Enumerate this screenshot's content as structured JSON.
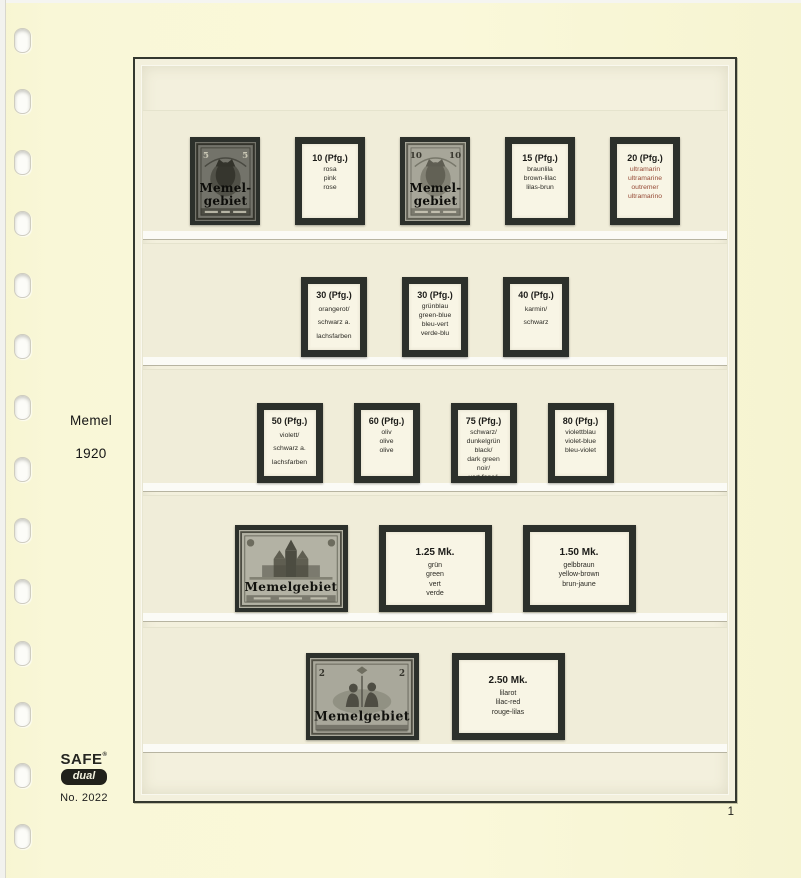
{
  "sidebar": {
    "title": "Memel",
    "year": "1920"
  },
  "footer": {
    "brand_top": "SAFE",
    "brand_reg": "®",
    "brand_bottom": "dual",
    "item_number": "No. 2022",
    "page_number": "1"
  },
  "palette": {
    "page_background": "#f9f7d8",
    "mount_black": "#2c302b",
    "label_background": "#f8f5e5",
    "accent_text": "#964a36"
  },
  "rows": [
    {
      "items": [
        {
          "type": "stamp",
          "shape": "portrait",
          "design": "germania",
          "tone": "dark",
          "value": "5",
          "overprint": [
            "Memel-",
            "gebiet"
          ]
        },
        {
          "type": "label",
          "shape": "portrait",
          "value": "10 (Pfg.)",
          "colors": [
            "rosa",
            "pink",
            "rose"
          ]
        },
        {
          "type": "stamp",
          "shape": "portrait",
          "design": "germania",
          "tone": "light",
          "value": "10",
          "overprint": [
            "Memel-",
            "gebiet"
          ]
        },
        {
          "type": "label",
          "shape": "portrait",
          "value": "15 (Pfg.)",
          "colors": [
            "braunlila",
            "brown-lilac",
            "lilas-brun"
          ]
        },
        {
          "type": "label",
          "shape": "portrait",
          "value": "20 (Pfg.)",
          "accent": true,
          "colors": [
            "ultramarin",
            "ultramarine",
            "outremer",
            "ultramarino"
          ]
        }
      ]
    },
    {
      "items": [
        {
          "type": "label",
          "shape": "portrait",
          "spread": true,
          "value": "30 (Pfg.)",
          "colors": [
            "orangerot/",
            "schwarz a.",
            "lachsfarben"
          ]
        },
        {
          "type": "label",
          "shape": "portrait",
          "value": "30 (Pfg.)",
          "colors": [
            "grünblau",
            "green-blue",
            "bleu-vert",
            "verde-blu"
          ]
        },
        {
          "type": "label",
          "shape": "portrait",
          "spread": true,
          "value": "40 (Pfg.)",
          "colors": [
            "karmin/",
            "schwarz"
          ]
        }
      ]
    },
    {
      "items": [
        {
          "type": "label",
          "shape": "portrait",
          "spread": true,
          "value": "50 (Pfg.)",
          "colors": [
            "violett/",
            "schwarz a.",
            "lachsfarben"
          ]
        },
        {
          "type": "label",
          "shape": "portrait",
          "value": "60 (Pfg.)",
          "colors": [
            "oliv",
            "olive",
            "olive"
          ]
        },
        {
          "type": "label",
          "shape": "portrait",
          "value": "75 (Pfg.)",
          "colors": [
            "schwarz/",
            "dunkelgrün",
            "black/",
            "dark green",
            "noir/",
            "vert foncé"
          ]
        },
        {
          "type": "label",
          "shape": "portrait",
          "value": "80 (Pfg.)",
          "colors": [
            "violettblau",
            "violet-blue",
            "bleu-violet"
          ]
        }
      ]
    },
    {
      "items": [
        {
          "type": "stamp",
          "shape": "landscape",
          "design": "cathedral",
          "tone": "light",
          "overprint": [
            "Memelgebiet"
          ]
        },
        {
          "type": "label",
          "shape": "landscape",
          "value": "1.25 Mk.",
          "colors": [
            "grün",
            "green",
            "vert",
            "verde"
          ]
        },
        {
          "type": "label",
          "shape": "landscape",
          "value": "1.50 Mk.",
          "colors": [
            "gelbbraun",
            "yellow-brown",
            "brun-jaune"
          ]
        }
      ]
    },
    {
      "items": [
        {
          "type": "stamp",
          "shape": "landscape",
          "design": "figures",
          "tone": "light",
          "value": "2",
          "overprint": [
            "Memelgebiet"
          ]
        },
        {
          "type": "label",
          "shape": "landscape",
          "value": "2.50 Mk.",
          "colors": [
            "lilarot",
            "lilac-red",
            "rouge-lilas"
          ]
        }
      ]
    }
  ]
}
